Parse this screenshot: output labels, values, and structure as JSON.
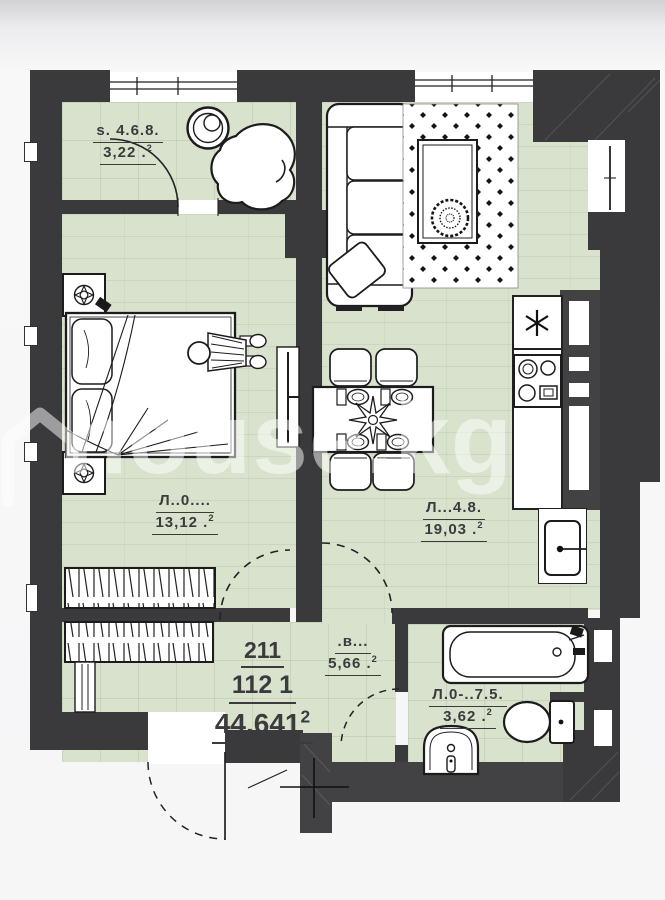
{
  "plan": {
    "watermark": {
      "text": "house.kg",
      "icon": "house-icon"
    },
    "apartment": {
      "number": "211",
      "block": "112 1",
      "total_area": "44,641",
      "sup": "2"
    },
    "rooms": [
      {
        "id": "storage",
        "name": "s. 4.6.8.",
        "area": "3,22 .",
        "sup": "2"
      },
      {
        "id": "bedroom",
        "name": "Л..0....",
        "area": "13,12 .",
        "sup": "2"
      },
      {
        "id": "living",
        "name": "Л...4.8.",
        "area": "19,03 .",
        "sup": "2"
      },
      {
        "id": "hall",
        "name": ".в...",
        "area": "5,66 .",
        "sup": "2"
      },
      {
        "id": "bathroom",
        "name": "Л.0-..7.5.",
        "area": "3,62 .",
        "sup": "2"
      }
    ],
    "colors": {
      "floor": "#d8e2cd",
      "wall": "#3a3a3c",
      "label": "#3b3b3d",
      "background": "#f6f6f7",
      "watermark": "rgba(255,255,255,0.5)"
    },
    "icons": [
      "washing-machine-icon",
      "armchair-icon",
      "bed-icon",
      "pillow-icon",
      "nightstand-icon",
      "table-lamp-icon",
      "person-figure-icon",
      "tv-icon",
      "sofa-icon",
      "rug-icon",
      "coffee-table-icon",
      "plant-icon",
      "dining-table-icon",
      "chair-icon",
      "place-setting-icon",
      "flower-centerpiece-icon",
      "asterisk-symbol",
      "stove-icon",
      "kitchen-sink-icon",
      "bathtub-icon",
      "toilet-icon",
      "bathroom-sink-icon",
      "wardrobe-icon",
      "door-swing-arc",
      "entrance-door-arc",
      "house-icon"
    ]
  }
}
